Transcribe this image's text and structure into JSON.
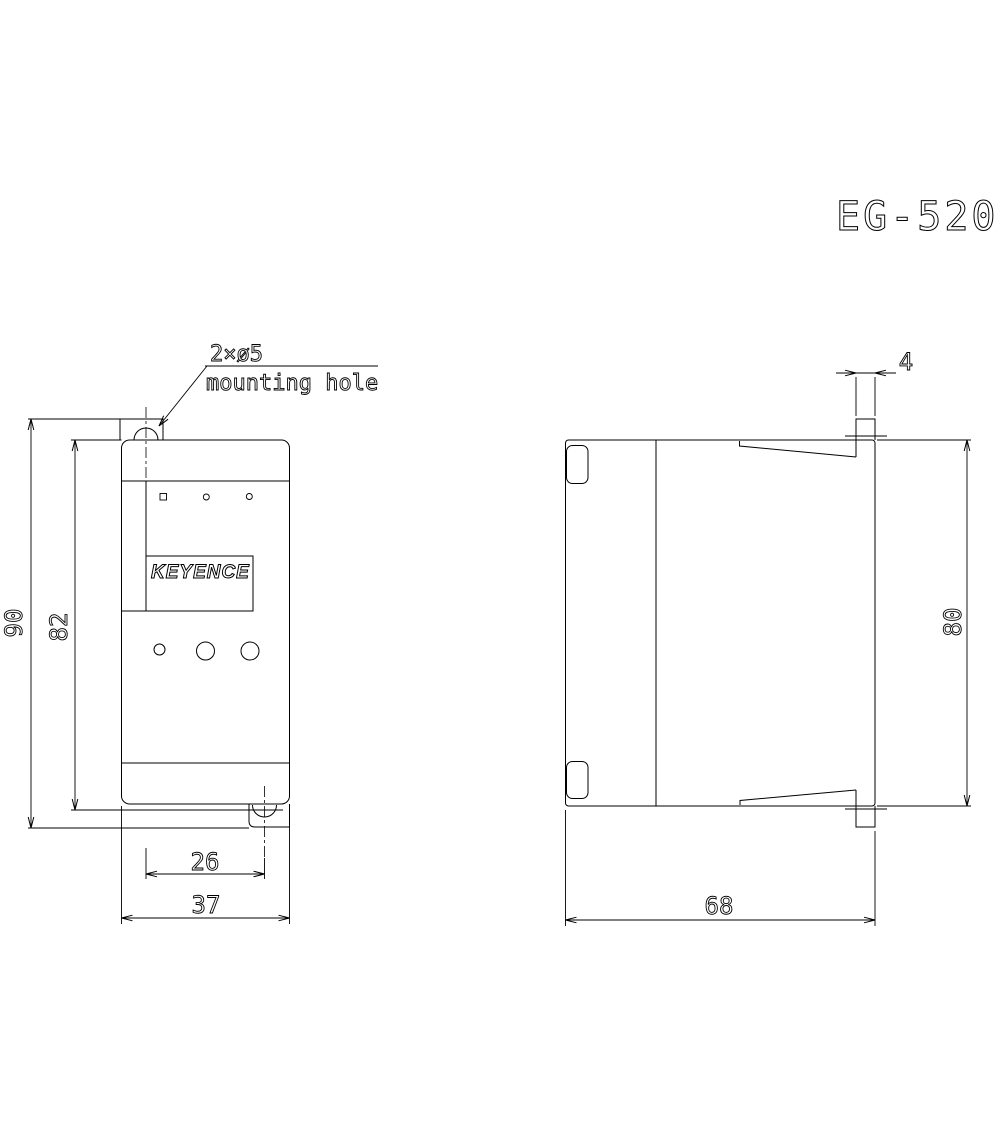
{
  "title": "EG-520",
  "callout": {
    "size": "2×ø5",
    "label": "mounting hole"
  },
  "front_view": {
    "logo": "KEYENCE",
    "dims": {
      "overall_height": "90",
      "body_height": "82",
      "hole_pitch": "26",
      "width": "37"
    }
  },
  "side_view": {
    "dims": {
      "tab_thickness": "4",
      "height": "80",
      "depth": "68"
    }
  },
  "colors": {
    "line": "#000000",
    "background": "#ffffff"
  }
}
